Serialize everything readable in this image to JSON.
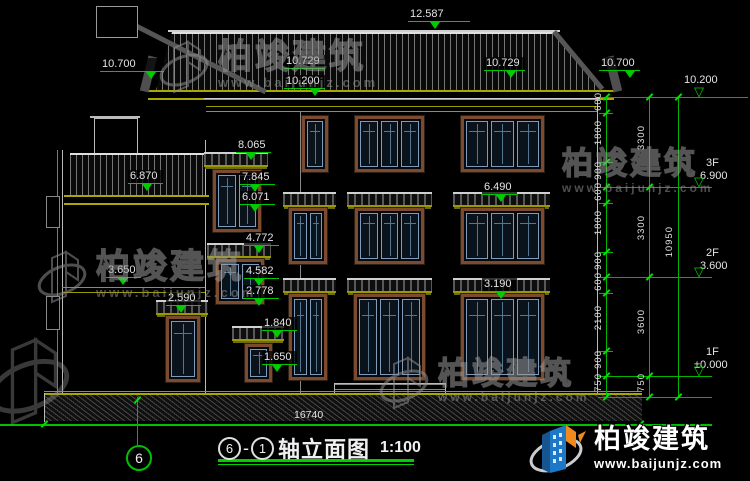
{
  "watermark": {
    "brand": "柏竣建筑",
    "url": "www.baijunjz.com"
  },
  "brand_logo": {
    "brand": "柏竣建筑",
    "url": "www.baijunjz.com"
  },
  "drawing_title": {
    "axis_start": "6",
    "dash": "-",
    "axis_end": "1",
    "name": "轴立面图",
    "scale": "1:100"
  },
  "axis_bubble": "6",
  "elevations": {
    "ridge": "12.587",
    "eave_left": "10.700",
    "eave_left_upper": "10.729",
    "wall_top_left": "10.200",
    "eave_right_upper": "10.729",
    "eave_right": "10.700",
    "f3_window_canopy": "8.065",
    "f3_window_head": "7.845",
    "f3_window_sill": "6.071",
    "annex_roof": "6.870",
    "f3_canopy_main": "6.490",
    "f2_window_canopy": "4.772",
    "f2_window_head": "4.582",
    "annex_band": "3.650",
    "f1_canopy_main": "3.190",
    "f2_window_sill": "2.778",
    "annex_door_canopy": "2.590",
    "porch_canopy": "1.840",
    "porch_door_head": "1.650"
  },
  "levels": {
    "top": {
      "floor": "",
      "value": "10.200"
    },
    "f3": {
      "floor": "3F",
      "value": "6.900"
    },
    "f2": {
      "floor": "2F",
      "value": "3.600"
    },
    "f1": {
      "floor": "1F",
      "value": "±0.000"
    }
  },
  "dimensions": {
    "segments": [
      "600",
      "1800",
      "900",
      "600",
      "1800",
      "900",
      "600",
      "2100",
      "900",
      "750"
    ],
    "floors": [
      "3300",
      "3300",
      "3600",
      "750"
    ],
    "total_height": "10950",
    "total_width": "16740"
  }
}
